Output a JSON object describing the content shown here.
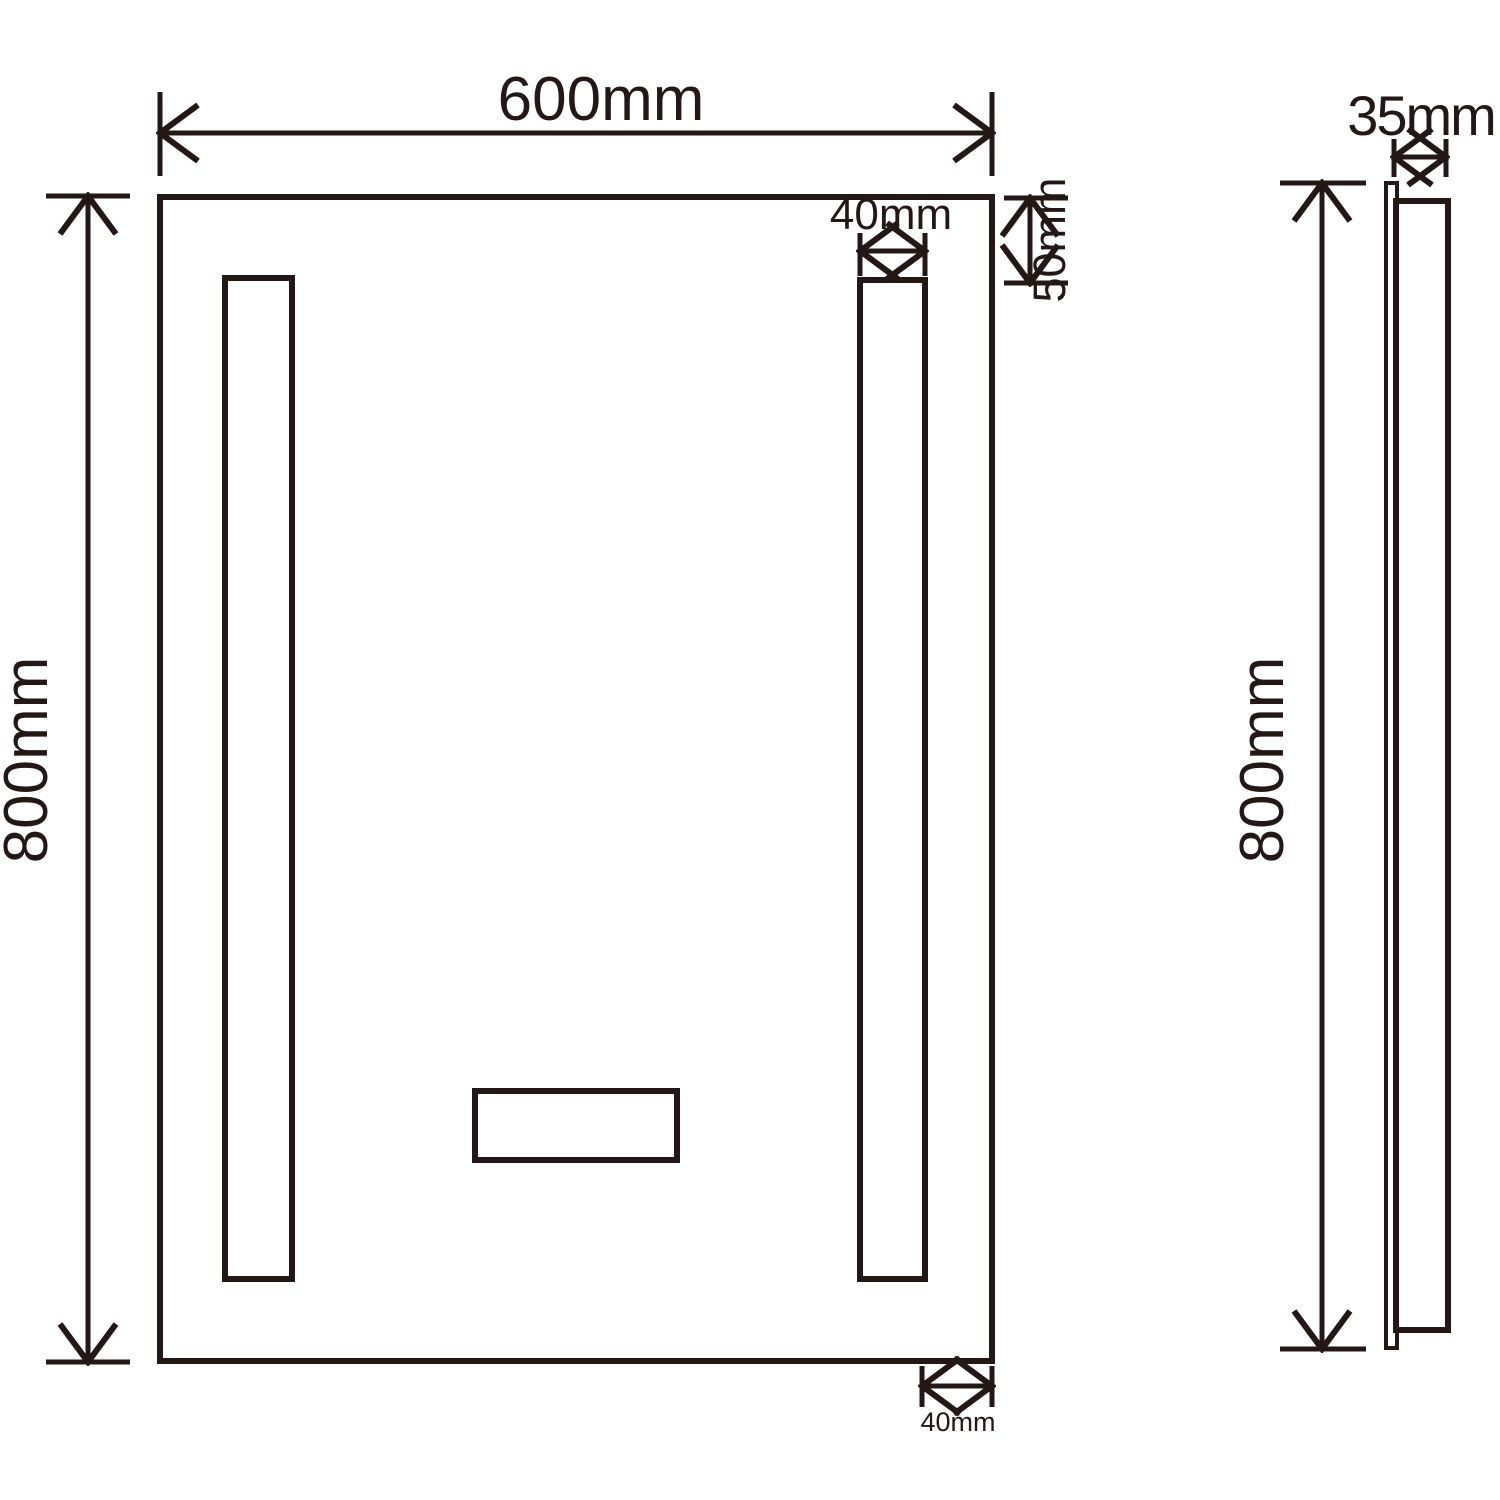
{
  "colors": {
    "line": "#231815",
    "background": "#ffffff"
  },
  "front_view": {
    "width_label": "600mm",
    "height_label": "800mm",
    "strip_width_label": "40mm",
    "strip_top_gap_label": "50mm",
    "strip_side_gap_label": "40mm"
  },
  "side_view": {
    "depth_label": "35mm",
    "height_label": "800mm"
  }
}
